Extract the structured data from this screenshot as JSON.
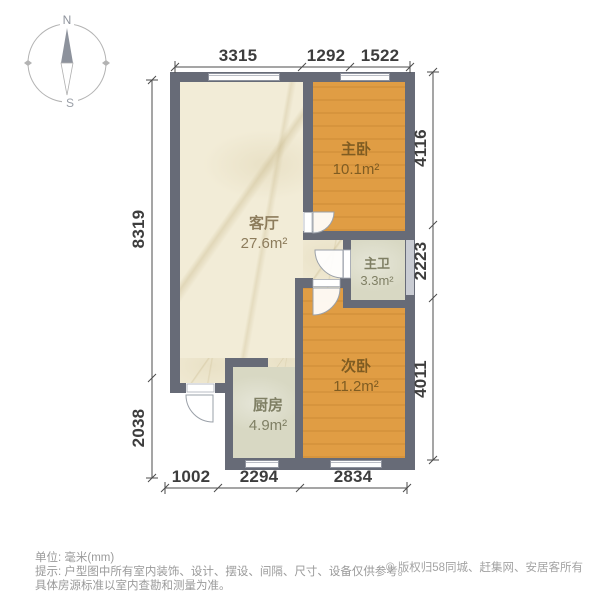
{
  "compass": {
    "north": "N",
    "south": "S"
  },
  "dimensions": {
    "top": [
      "3315",
      "1292",
      "1522"
    ],
    "bottom": [
      "1002",
      "2294",
      "2834"
    ],
    "left": [
      "8319",
      "2038"
    ],
    "right": [
      "4116",
      "2223",
      "4011"
    ]
  },
  "rooms": {
    "living": {
      "name": "客厅",
      "area": "27.6m²"
    },
    "master": {
      "name": "主卧",
      "area": "10.1m²"
    },
    "bath": {
      "name": "主卫",
      "area": "3.3m²"
    },
    "second": {
      "name": "次卧",
      "area": "11.2m²"
    },
    "kitchen": {
      "name": "厨房",
      "area": "4.9m²"
    }
  },
  "footer": {
    "unit": "单位: 毫米(mm)",
    "tip_line1": "提示: 户型图中所有室内装饰、设计、摆设、间隔、尺寸、设备仅供参考。",
    "tip_line2": "具体房源标准以室内查勘和测量为准。",
    "copyright": "© 版权归58同城、赶集网、安居客所有"
  },
  "colors": {
    "wall": "#676b77",
    "living_floor": "#f2ecd7",
    "bedroom_floor": "#e09d44",
    "wet_floor": "#d8d8c3",
    "dimension_text": "#3d3d3d",
    "footer_text": "#9a9a9a"
  }
}
